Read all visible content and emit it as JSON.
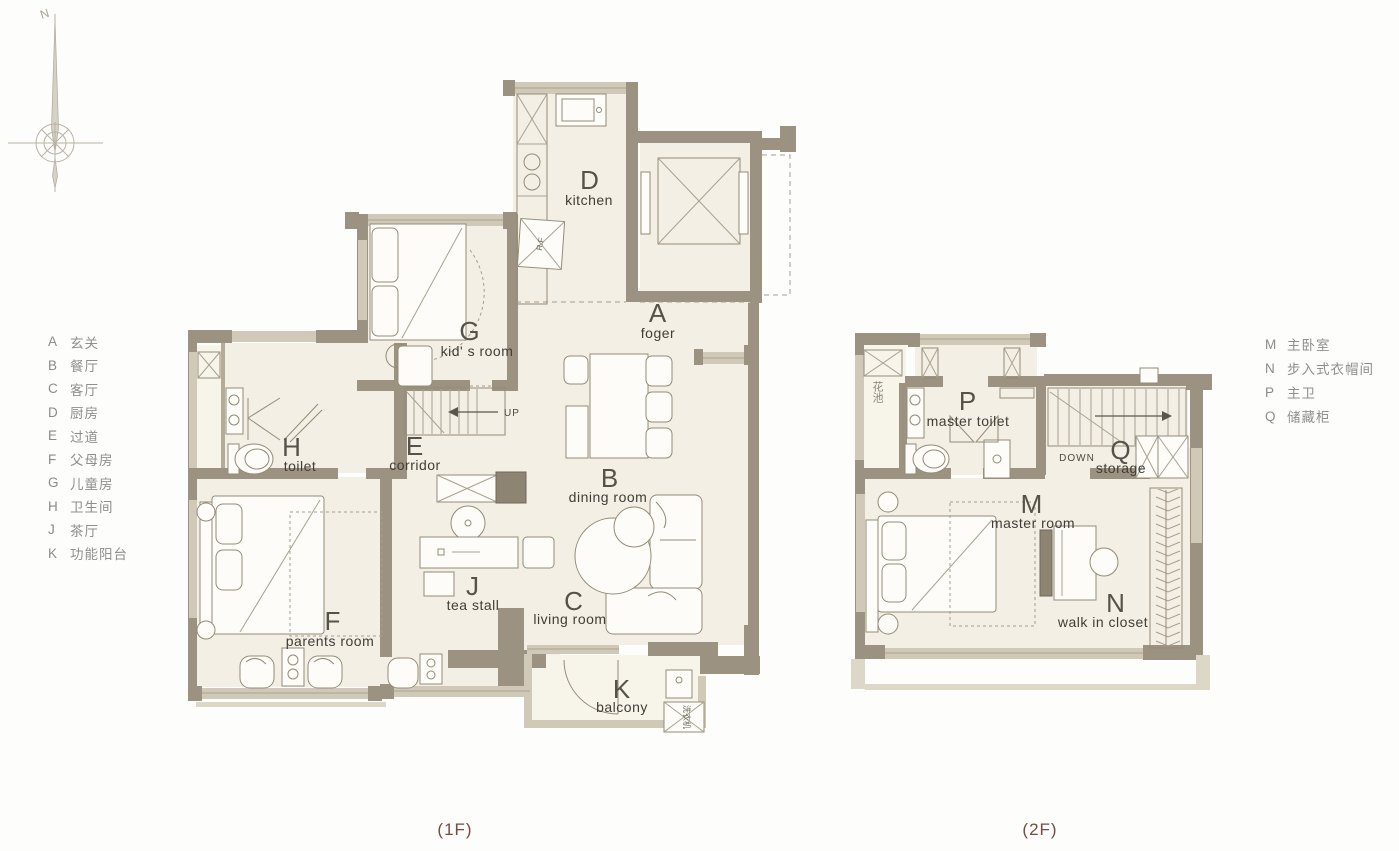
{
  "compass": {
    "north_label": "N"
  },
  "legend_left": {
    "items": [
      {
        "code": "A",
        "label": "玄关"
      },
      {
        "code": "B",
        "label": "餐厅"
      },
      {
        "code": "C",
        "label": "客厅"
      },
      {
        "code": "D",
        "label": "厨房"
      },
      {
        "code": "E",
        "label": "过道"
      },
      {
        "code": "F",
        "label": "父母房"
      },
      {
        "code": "G",
        "label": "儿童房"
      },
      {
        "code": "H",
        "label": "卫生间"
      },
      {
        "code": "J",
        "label": "茶厅"
      },
      {
        "code": "K",
        "label": "功能阳台"
      }
    ]
  },
  "legend_right": {
    "items": [
      {
        "code": "M",
        "label": "主卧室"
      },
      {
        "code": "N",
        "label": "步入式衣帽间"
      },
      {
        "code": "P",
        "label": "主卫"
      },
      {
        "code": "Q",
        "label": "储藏柜"
      }
    ]
  },
  "floor1": {
    "caption": "(1F)",
    "rooms": {
      "foyer": {
        "code": "A",
        "name": "foger"
      },
      "dining": {
        "code": "B",
        "name": "dining room"
      },
      "living": {
        "code": "C",
        "name": "living room"
      },
      "kitchen": {
        "code": "D",
        "name": "kitchen"
      },
      "corridor": {
        "code": "E",
        "name": "corridor"
      },
      "parents": {
        "code": "F",
        "name": "parents room"
      },
      "kids": {
        "code": "G",
        "name": "kid' s room"
      },
      "toilet": {
        "code": "H",
        "name": "toilet"
      },
      "tea": {
        "code": "J",
        "name": "tea stall"
      },
      "balcony": {
        "code": "K",
        "name": "balcony"
      }
    },
    "annotations": {
      "up": "UP",
      "fridge": "R.F",
      "washer": "洗衣机"
    }
  },
  "floor2": {
    "caption": "(2F)",
    "rooms": {
      "master": {
        "code": "M",
        "name": "master room"
      },
      "closet": {
        "code": "N",
        "name": "walk in closet"
      },
      "toilet": {
        "code": "P",
        "name": "master toilet"
      },
      "storage": {
        "code": "Q",
        "name": "storage"
      }
    },
    "annotations": {
      "down": "DOWN",
      "flower": "花池"
    }
  }
}
